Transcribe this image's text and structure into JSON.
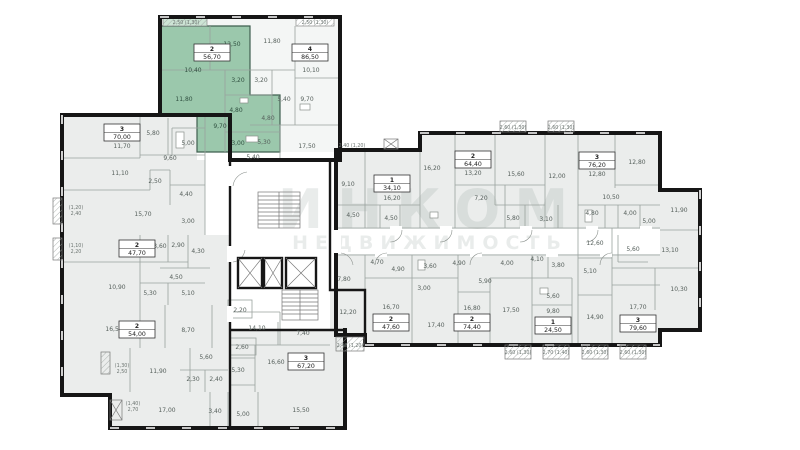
{
  "watermark": {
    "line1": "ИНКОМ",
    "line2": "НЕДВИЖИМОСТЬ"
  },
  "colors": {
    "highlight": "#9bc8ac",
    "highlight_balcony": "#cde4d5",
    "room_fill": "#ebedec",
    "light_fill": "#f4f6f5",
    "wall": "#161616"
  },
  "units": [
    {
      "number": "2",
      "area": "56,70",
      "highlighted": true
    },
    {
      "number": "4",
      "area": "86,50",
      "highlighted": false
    },
    {
      "number": "3",
      "area": "70,00",
      "highlighted": false
    },
    {
      "number": "2",
      "area": "47,70",
      "highlighted": false
    },
    {
      "number": "2",
      "area": "54,00",
      "highlighted": false
    },
    {
      "number": "3",
      "area": "67,20",
      "highlighted": false
    },
    {
      "number": "1",
      "area": "34,10",
      "highlighted": false
    },
    {
      "number": "2",
      "area": "64,40",
      "highlighted": false
    },
    {
      "number": "3",
      "area": "76,20",
      "highlighted": false
    },
    {
      "number": "2",
      "area": "47,60",
      "highlighted": false
    },
    {
      "number": "2",
      "area": "74,40",
      "highlighted": false
    },
    {
      "number": "1",
      "area": "24,50",
      "highlighted": false
    },
    {
      "number": "3",
      "area": "79,60",
      "highlighted": false
    }
  ],
  "rooms": [
    "10,40",
    "12,50",
    "11,80",
    "3,20",
    "4,80",
    "9,70",
    "3,00",
    "11,80",
    "10,10",
    "3,20",
    "5,40",
    "9,70",
    "4,80",
    "5,30",
    "17,50",
    "5,40",
    "11,70",
    "5,80",
    "5,00",
    "9,60",
    "11,10",
    "2,50",
    "4,40",
    "15,70",
    "3,00",
    "13,60",
    "2,90",
    "4,30",
    "4,50",
    "10,90",
    "5,30",
    "5,10",
    "16,50",
    "8,70",
    "5,60",
    "11,90",
    "2,30",
    "2,40",
    "17,00",
    "3,40",
    "5,00",
    "15,50",
    "2,20",
    "14,10",
    "2,60",
    "5,30",
    "7,40",
    "16,60",
    "12,20",
    "7,80",
    "9,10",
    "16,20",
    "16,20",
    "13,20",
    "15,60",
    "7,20",
    "4,50",
    "4,50",
    "5,80",
    "12,00",
    "12,80",
    "12,80",
    "10,50",
    "4,80",
    "4,00",
    "5,00",
    "3,10",
    "11,90",
    "4,70",
    "4,90",
    "16,70",
    "17,40",
    "3,60",
    "3,00",
    "4,90",
    "5,90",
    "4,00",
    "16,80",
    "17,50",
    "4,10",
    "3,80",
    "5,10",
    "5,60",
    "9,80",
    "14,90",
    "12,60",
    "5,60",
    "13,10",
    "10,30",
    "17,70"
  ],
  "balconies": [
    "2,50 (1,30)",
    "2,50 (1,30)",
    "(1,20)",
    "2,40",
    "(1,10)",
    "2,20",
    "(1,30)",
    "2,50",
    "(1,40)",
    "2,70",
    "2,40 (1,20)",
    "2,40 (1,20)",
    "2,60 (1,30)",
    "2,60 (1,30)",
    "2,60 (1,30)",
    "2,70 (1,40)",
    "2,60 (1,30)",
    "2,60 (1,30)"
  ]
}
